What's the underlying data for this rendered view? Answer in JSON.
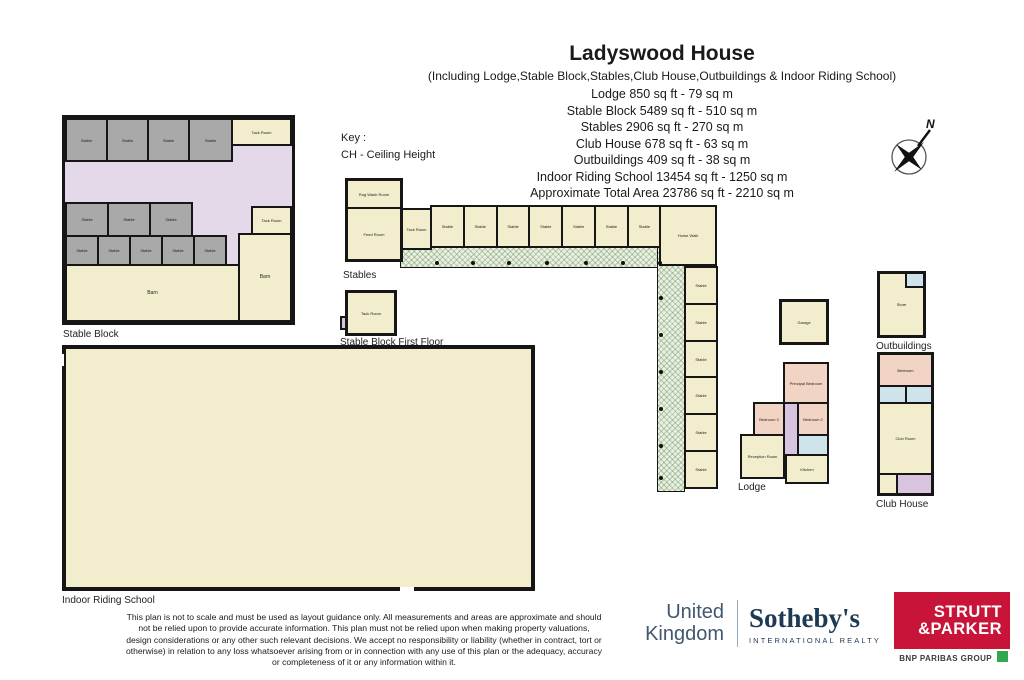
{
  "header": {
    "title": "Ladyswood House",
    "subtitle": "(Including Lodge,Stable Block,Stables,Club House,Outbuildings & Indoor Riding School)",
    "areas": [
      "Lodge 850 sq ft - 79 sq m",
      "Stable Block 5489 sq ft - 510 sq m",
      "Stables 2906 sq ft - 270 sq m",
      "Club House 678 sq ft - 63 sq m",
      "Outbuildings 409 sq ft - 38 sq m",
      "Indoor Riding School 13454 sq ft - 1250 sq m",
      "Approximate Total Area 23786 sq ft - 2210 sq m"
    ]
  },
  "key": {
    "label": "Key :",
    "item": "CH - Ceiling Height"
  },
  "compass": {
    "north": "N"
  },
  "plans": {
    "stable_block": {
      "label": "Stable Block",
      "top_stables": [
        "Stable",
        "Stable",
        "Stable",
        "Stable"
      ],
      "tack_room_top": "Tack Room",
      "mid_stables": [
        "Stable",
        "Stable",
        "Stable"
      ],
      "small_stables": [
        "Stable",
        "Stable",
        "Stable",
        "Stable",
        "Stable"
      ],
      "barn": "Barn",
      "tack_room_right": "Tack Room",
      "barn_right": "Barn"
    },
    "stables": {
      "label": "Stables",
      "rug_wash_room": "Rug Wash Room",
      "feed_room": "Feed Room",
      "tack_room": "Tack Room",
      "row_stables": [
        "Stable",
        "Stable",
        "Stable",
        "Stable",
        "Stable",
        "Stable",
        "Stable"
      ],
      "horse_walk": "Horse Walk",
      "wing_stables": [
        "Stable",
        "Stable",
        "Stable",
        "Stable",
        "Stable",
        "Stable"
      ]
    },
    "stable_block_first_floor": {
      "label": "Stable Block First Floor",
      "room": "Tack Room"
    },
    "indoor_riding_school": {
      "label": "Indoor Riding School"
    },
    "lodge": {
      "label": "Lodge",
      "garage": "Garage",
      "principal_bedroom": "Principal Bedroom",
      "bedroom2": "Bedroom 2",
      "bedroom3": "Bedroom 3",
      "reception_room": "Reception Room",
      "kitchen": "Kitchen"
    },
    "outbuildings": {
      "label": "Outbuildings",
      "room": "Store"
    },
    "club_house": {
      "label": "Club House",
      "bedroom": "Bedroom",
      "club_room": "Club Room"
    }
  },
  "footer": {
    "lines": [
      "This plan is not to scale and must be used as layout guidance only. All measurements and areas are approximate and should",
      "not be relied upon to provide accurate information. This plan must not be relied upon when making property valuations,",
      "design considerations or any other such relevant decisions. We accept no responsibility or liability (whether in contract, tort or",
      "otherwise) in relation to any loss whatsoever arising from or in connection with any use of this plan or the adequacy, accuracy",
      "or completeness of it or any information within it."
    ]
  },
  "logos": {
    "uk_sothebys": {
      "line1": "United",
      "line2": "Kingdom",
      "brand": "Sotheby's",
      "sub": "INTERNATIONAL REALTY"
    },
    "strutt": {
      "line1": "STRUTT",
      "line2": "&PARKER",
      "group": "BNP PARIBAS GROUP"
    }
  },
  "colors": {
    "room_cream": "#f2eecd",
    "room_gray": "#a9a9a9",
    "corridor_lavender": "#e4d9e9",
    "room_pink": "#f1d4c3",
    "room_blue": "#cfe4ea",
    "room_purple": "#d9c4e0",
    "wall": "#161616",
    "walkway_green": "#eaf0e0",
    "sothebys_navy": "#1d3a55",
    "strutt_red": "#c9143a",
    "bnp_green": "#2fa84f"
  }
}
